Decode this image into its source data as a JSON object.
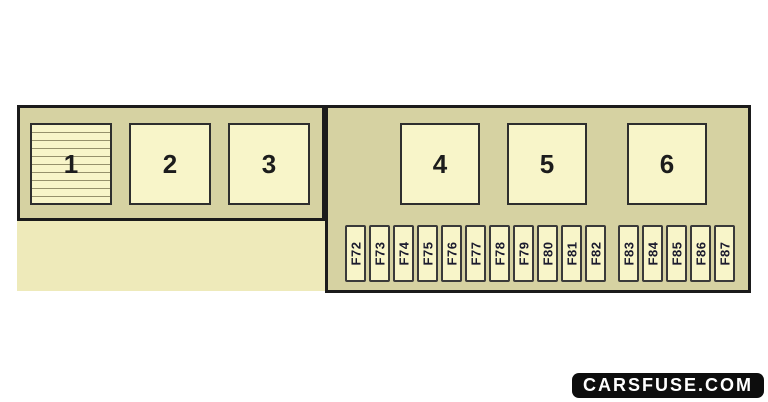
{
  "diagram": {
    "name": "fuse-box-diagram",
    "left_panel": {
      "modules": [
        {
          "label": "1",
          "hatched": true
        },
        {
          "label": "2",
          "hatched": false
        },
        {
          "label": "3",
          "hatched": false
        }
      ]
    },
    "right_panel": {
      "modules": [
        {
          "label": "4"
        },
        {
          "label": "5"
        },
        {
          "label": "6"
        }
      ],
      "fuse_group_a": [
        "F72",
        "F73",
        "F74",
        "F75",
        "F76",
        "F77",
        "F78",
        "F79",
        "F80",
        "F81",
        "F82"
      ],
      "fuse_group_b": [
        "F83",
        "F84",
        "F85",
        "F86",
        "F87"
      ]
    },
    "colors": {
      "page_bg": "#ffffff",
      "panel_fill": "#d6d2a2",
      "panel_border": "#1b1b1b",
      "module_fill": "#f8f5c9",
      "module_border": "#2e2e2e",
      "light_area_fill": "#eeeaba",
      "hatch_line": "#96916c",
      "fuse_border": "#3a3a3a",
      "fuse_text": "#1b1b2e",
      "number_text": "#1c1c1c",
      "watermark_bg": "#0d0d0d",
      "watermark_fg": "#ffffff"
    }
  },
  "watermark": {
    "label": "CARSFUSE.COM"
  }
}
